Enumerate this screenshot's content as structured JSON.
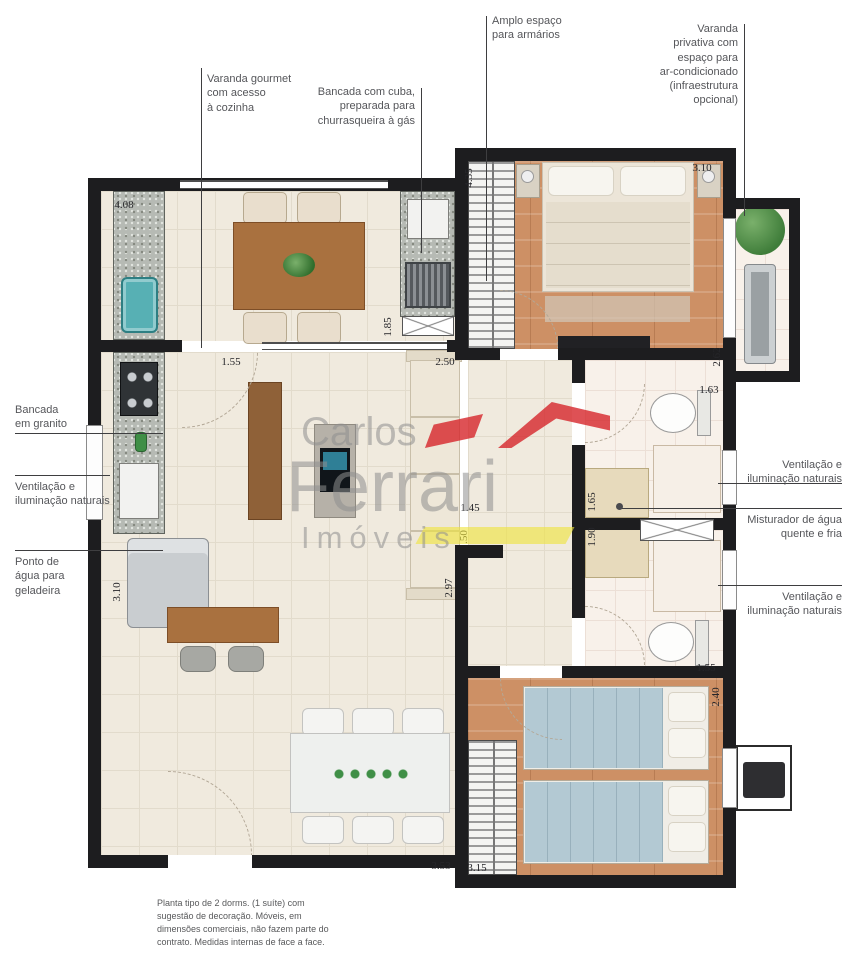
{
  "callouts": {
    "varanda_gourmet": "Varanda gourmet\ncom acesso\nà cozinha",
    "bancada_cuba": "Bancada com cuba,\npreparada para\nchurrasqueira à gás",
    "armarios": "Amplo espaço\npara armários",
    "varanda_privativa": "Varanda\nprivativa com\nespaço para\nar-condicionado\n(infraestrutura\nopcional)",
    "bancada_granito": "Bancada\nem granito",
    "ventilacao_esq": "Ventilação e\niluminação naturais",
    "ponto_agua": "Ponto de\nágua para\ngeladeira",
    "ventilacao_dir_1": "Ventilação e\niluminação naturais",
    "misturador": "Misturador de água\nquente e fria",
    "ventilacao_dir_2": "Ventilação e\niluminação naturais"
  },
  "dimensions": [
    {
      "value": "4.08"
    },
    {
      "value": "1.55"
    },
    {
      "value": "2.50"
    },
    {
      "value": "1.85"
    },
    {
      "value": "4.35"
    },
    {
      "value": "3.10"
    },
    {
      "value": "2.62"
    },
    {
      "value": "1.63"
    },
    {
      "value": "1.65"
    },
    {
      "value": "1.90"
    },
    {
      "value": "1.45"
    },
    {
      "value": ".50"
    },
    {
      "value": "3.10"
    },
    {
      "value": "2.97"
    },
    {
      "value": "1.55"
    },
    {
      "value": "2.40"
    },
    {
      "value": "3.53"
    },
    {
      "value": "3.15"
    }
  ],
  "watermark": {
    "word1": "Carlos",
    "word2": "Ferrari",
    "word3": "Imóveis"
  },
  "disclaimer": "Planta tipo de 2 dorms. (1 suíte) com\nsugestão de decoração. Móveis, em\ndimensões comerciais, não fazem parte do\ncontrato. Medidas internas de face a face.",
  "colors": {
    "wall": "#1d1d1f",
    "wood_floor": "#cd9065",
    "tile_floor": "#f0eade",
    "accent_red": "#d6262b",
    "accent_yellow": "#efe43d",
    "sink_teal": "#57b0b4",
    "bed2_blue": "#b3c9d3"
  }
}
